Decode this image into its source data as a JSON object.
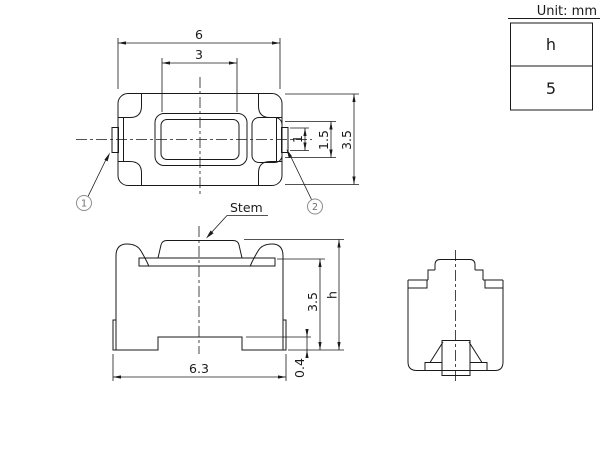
{
  "unit_note": "Unit: mm",
  "spec_table": {
    "parameter": "h",
    "value": "5"
  },
  "labels": {
    "stem": "Stem"
  },
  "callouts": {
    "terminal1": "1",
    "terminal2": "2"
  },
  "dimensions": {
    "top": {
      "body_width": "6",
      "stem_width": "3",
      "lead_width": "1",
      "contact_width": "1.5",
      "body_depth": "3.5"
    },
    "front": {
      "body_width": "6.3",
      "lead_standoff": "0.4",
      "body_height": "3.5",
      "total_height": "h"
    }
  },
  "colors": {
    "line": "#1a1a1a",
    "callout": "#8c8c8c",
    "background": "#ffffff"
  }
}
